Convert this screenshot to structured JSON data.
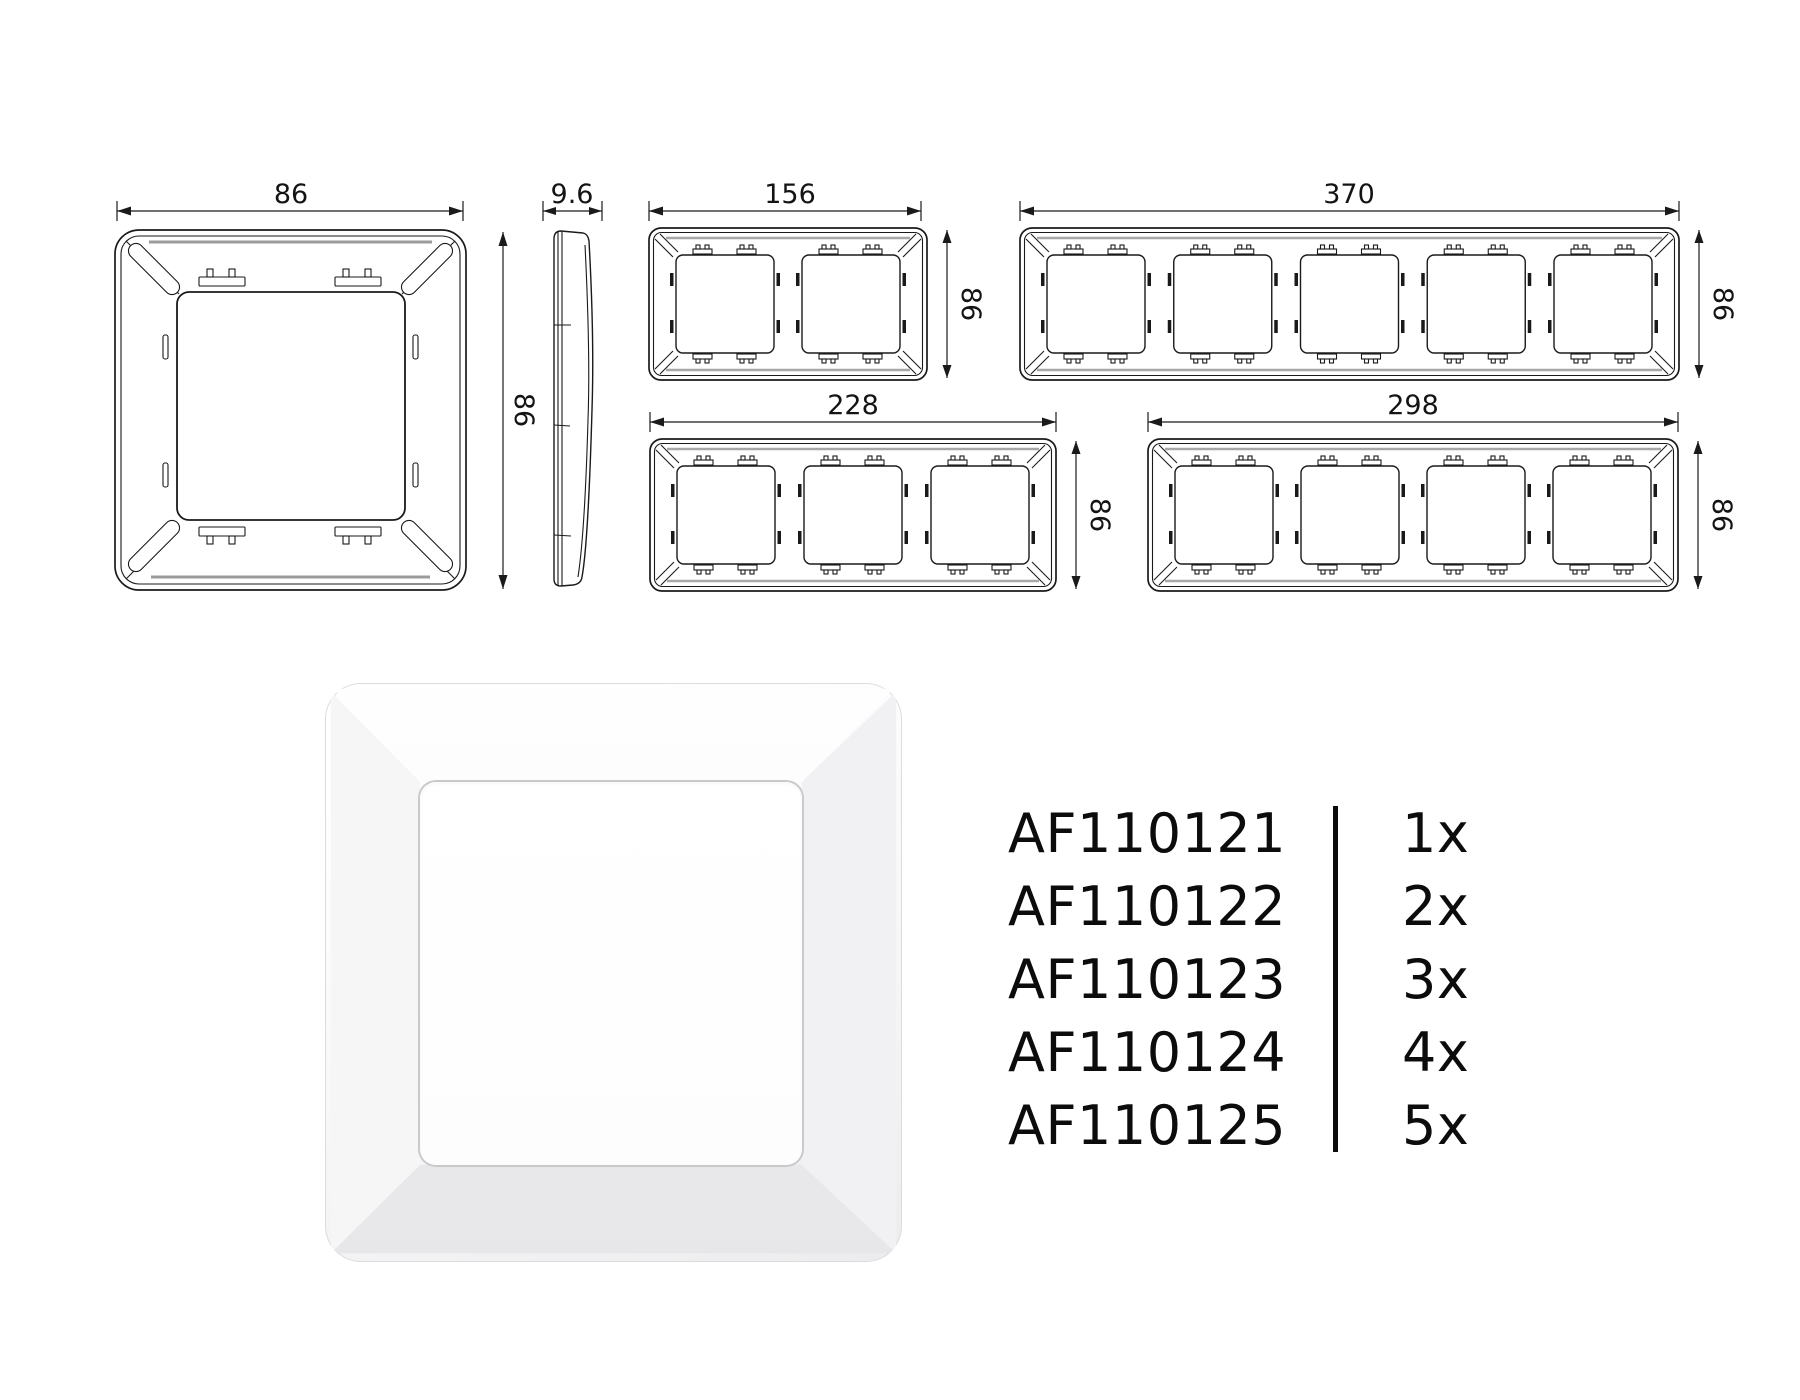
{
  "page": {
    "background": "#ffffff",
    "line_color": "#1a1a1a",
    "shade_color": "#9b9b9b"
  },
  "drawings": {
    "single_front": {
      "width_mm": "86",
      "height_mm": "86"
    },
    "side_profile": {
      "thickness_mm": "9.6"
    },
    "frame_2gang": {
      "width_mm": "156",
      "height_mm": "86",
      "gangs": 2
    },
    "frame_5gang": {
      "width_mm": "370",
      "height_mm": "86",
      "gangs": 5
    },
    "frame_3gang": {
      "width_mm": "228",
      "height_mm": "86",
      "gangs": 3
    },
    "frame_4gang": {
      "width_mm": "298",
      "height_mm": "86",
      "gangs": 4
    }
  },
  "parts_list": {
    "rows": [
      {
        "sku": "AF110121",
        "qty": "1x"
      },
      {
        "sku": "AF110122",
        "qty": "2x"
      },
      {
        "sku": "AF110123",
        "qty": "3x"
      },
      {
        "sku": "AF110124",
        "qty": "4x"
      },
      {
        "sku": "AF110125",
        "qty": "5x"
      }
    ]
  }
}
